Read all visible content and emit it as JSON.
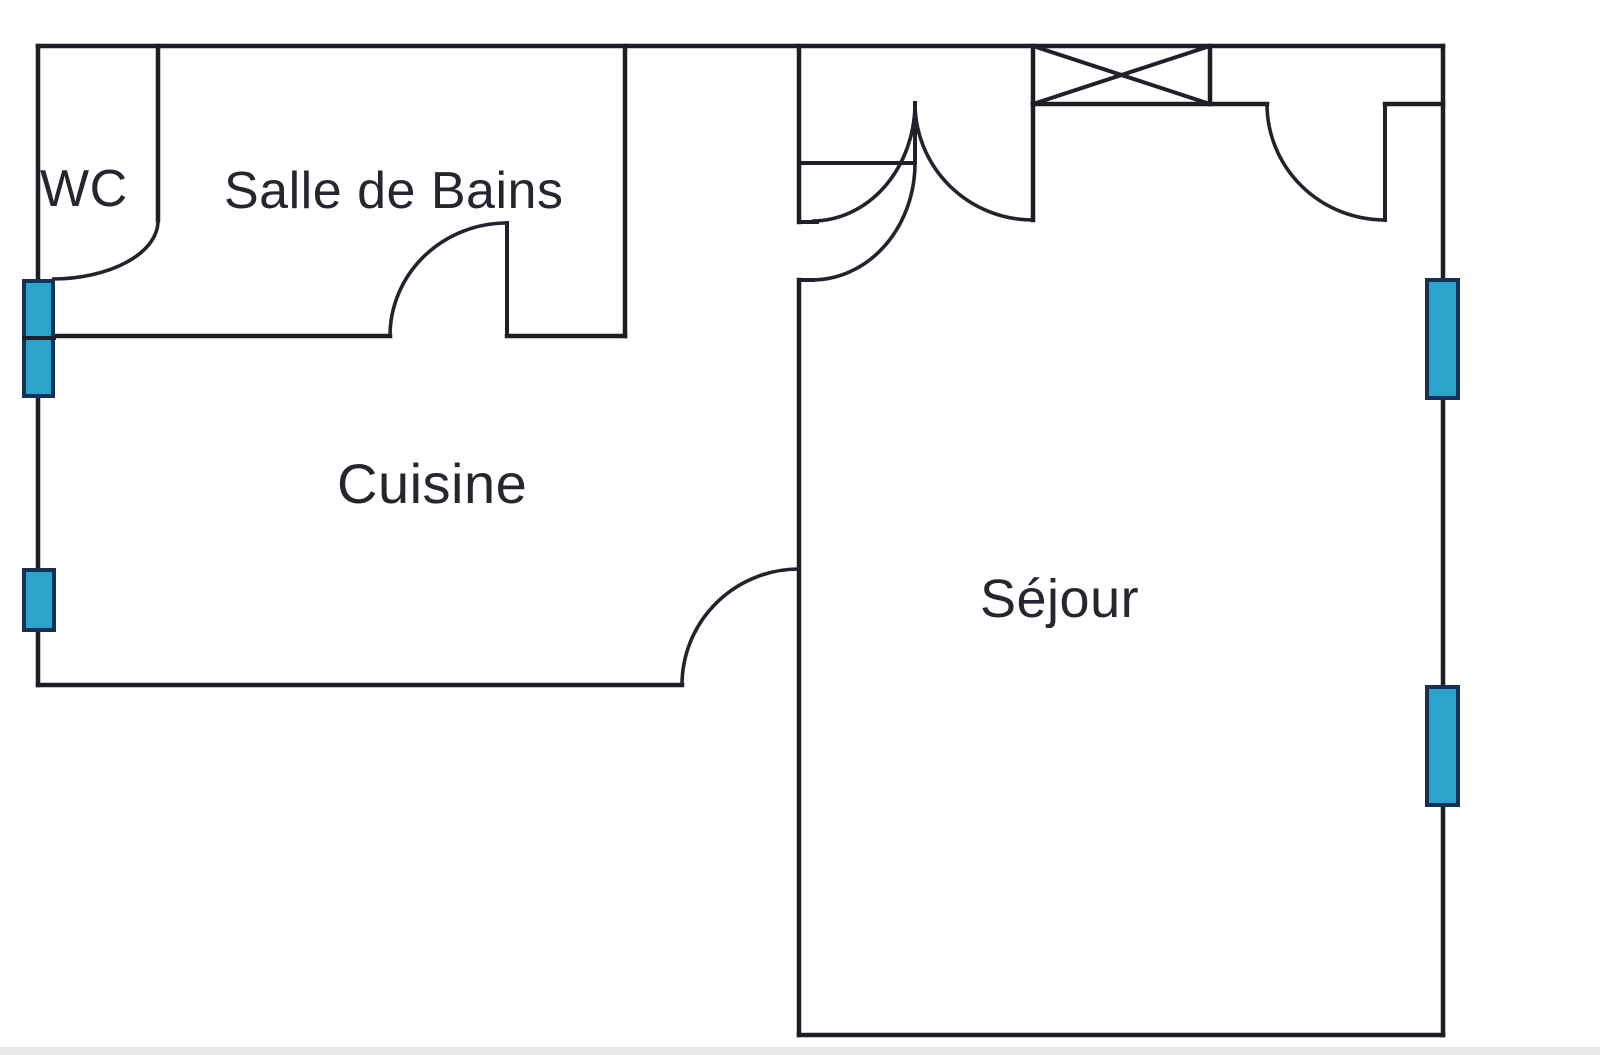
{
  "rooms": [
    {
      "id": "wc",
      "label": "WC"
    },
    {
      "id": "salle_de_bains",
      "label": "Salle de Bains"
    },
    {
      "id": "cuisine",
      "label": "Cuisine"
    },
    {
      "id": "sejour",
      "label": "Séjour"
    }
  ],
  "colors": {
    "wall_ink": "#1D1D26",
    "label_text": "#26262E",
    "window_fill": "#2BA4CB",
    "window_border": "#16305A",
    "scan_strip": "#E8E8EA"
  }
}
